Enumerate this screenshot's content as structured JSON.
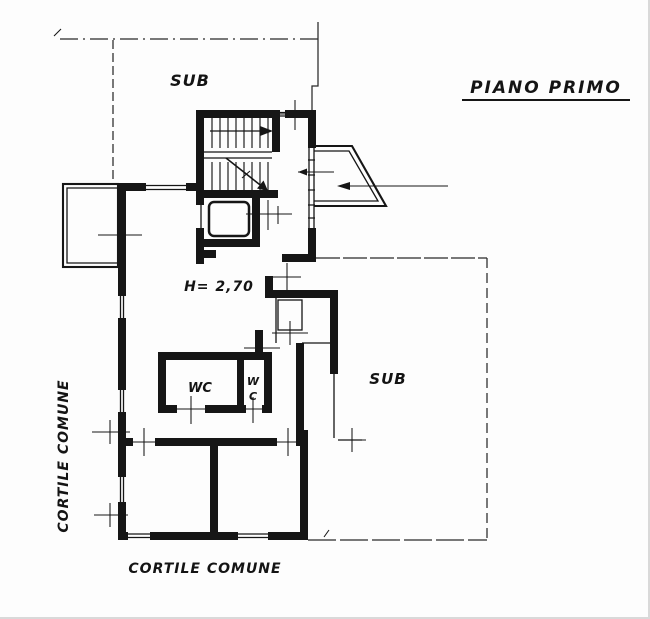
{
  "title": "PIANO PRIMO",
  "labels": {
    "sub_top": "SUB",
    "sub_right": "SUB",
    "height_note": "H= 2,70",
    "wc_left": "WC",
    "wc_right_top": "W",
    "wc_right_bottom": "C",
    "cortile_left": "CORTILE COMUNE",
    "cortile_bottom": "CORTILE COMUNE"
  },
  "colors": {
    "ink": "#161616",
    "paper": "#fdfdfd"
  }
}
